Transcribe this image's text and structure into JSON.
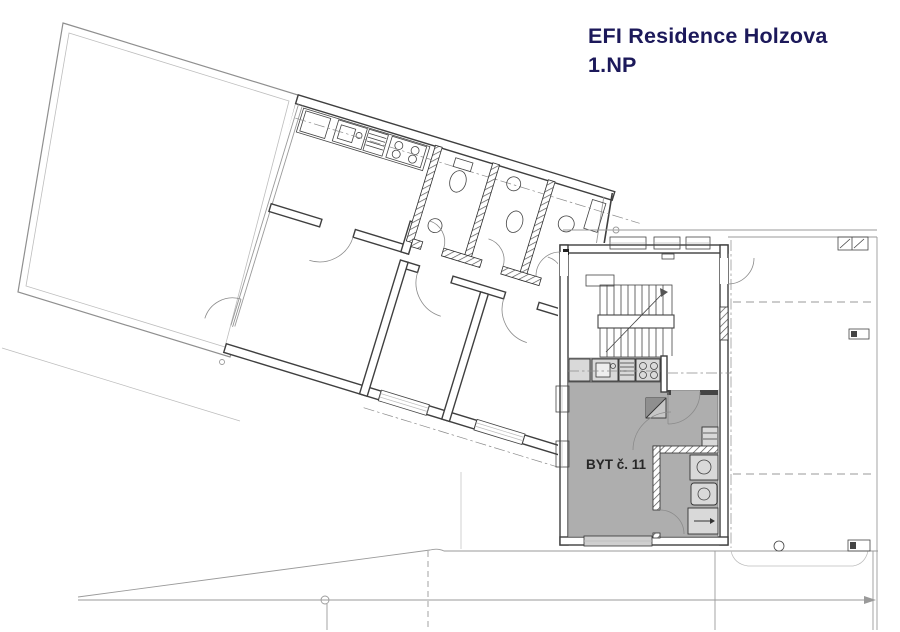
{
  "title": {
    "line1": "EFI Residence Holzova",
    "line2": "1.NP"
  },
  "plan": {
    "apartment_label": "BYT č. 11",
    "colors": {
      "title_text": "#1c195a",
      "apartment_fill": "#aeaeae",
      "wall_line": "#3f3f3f",
      "thin_line": "#9a9a9a",
      "fixture_fill": "#d9d9d9",
      "hatch_line": "#555555"
    }
  }
}
